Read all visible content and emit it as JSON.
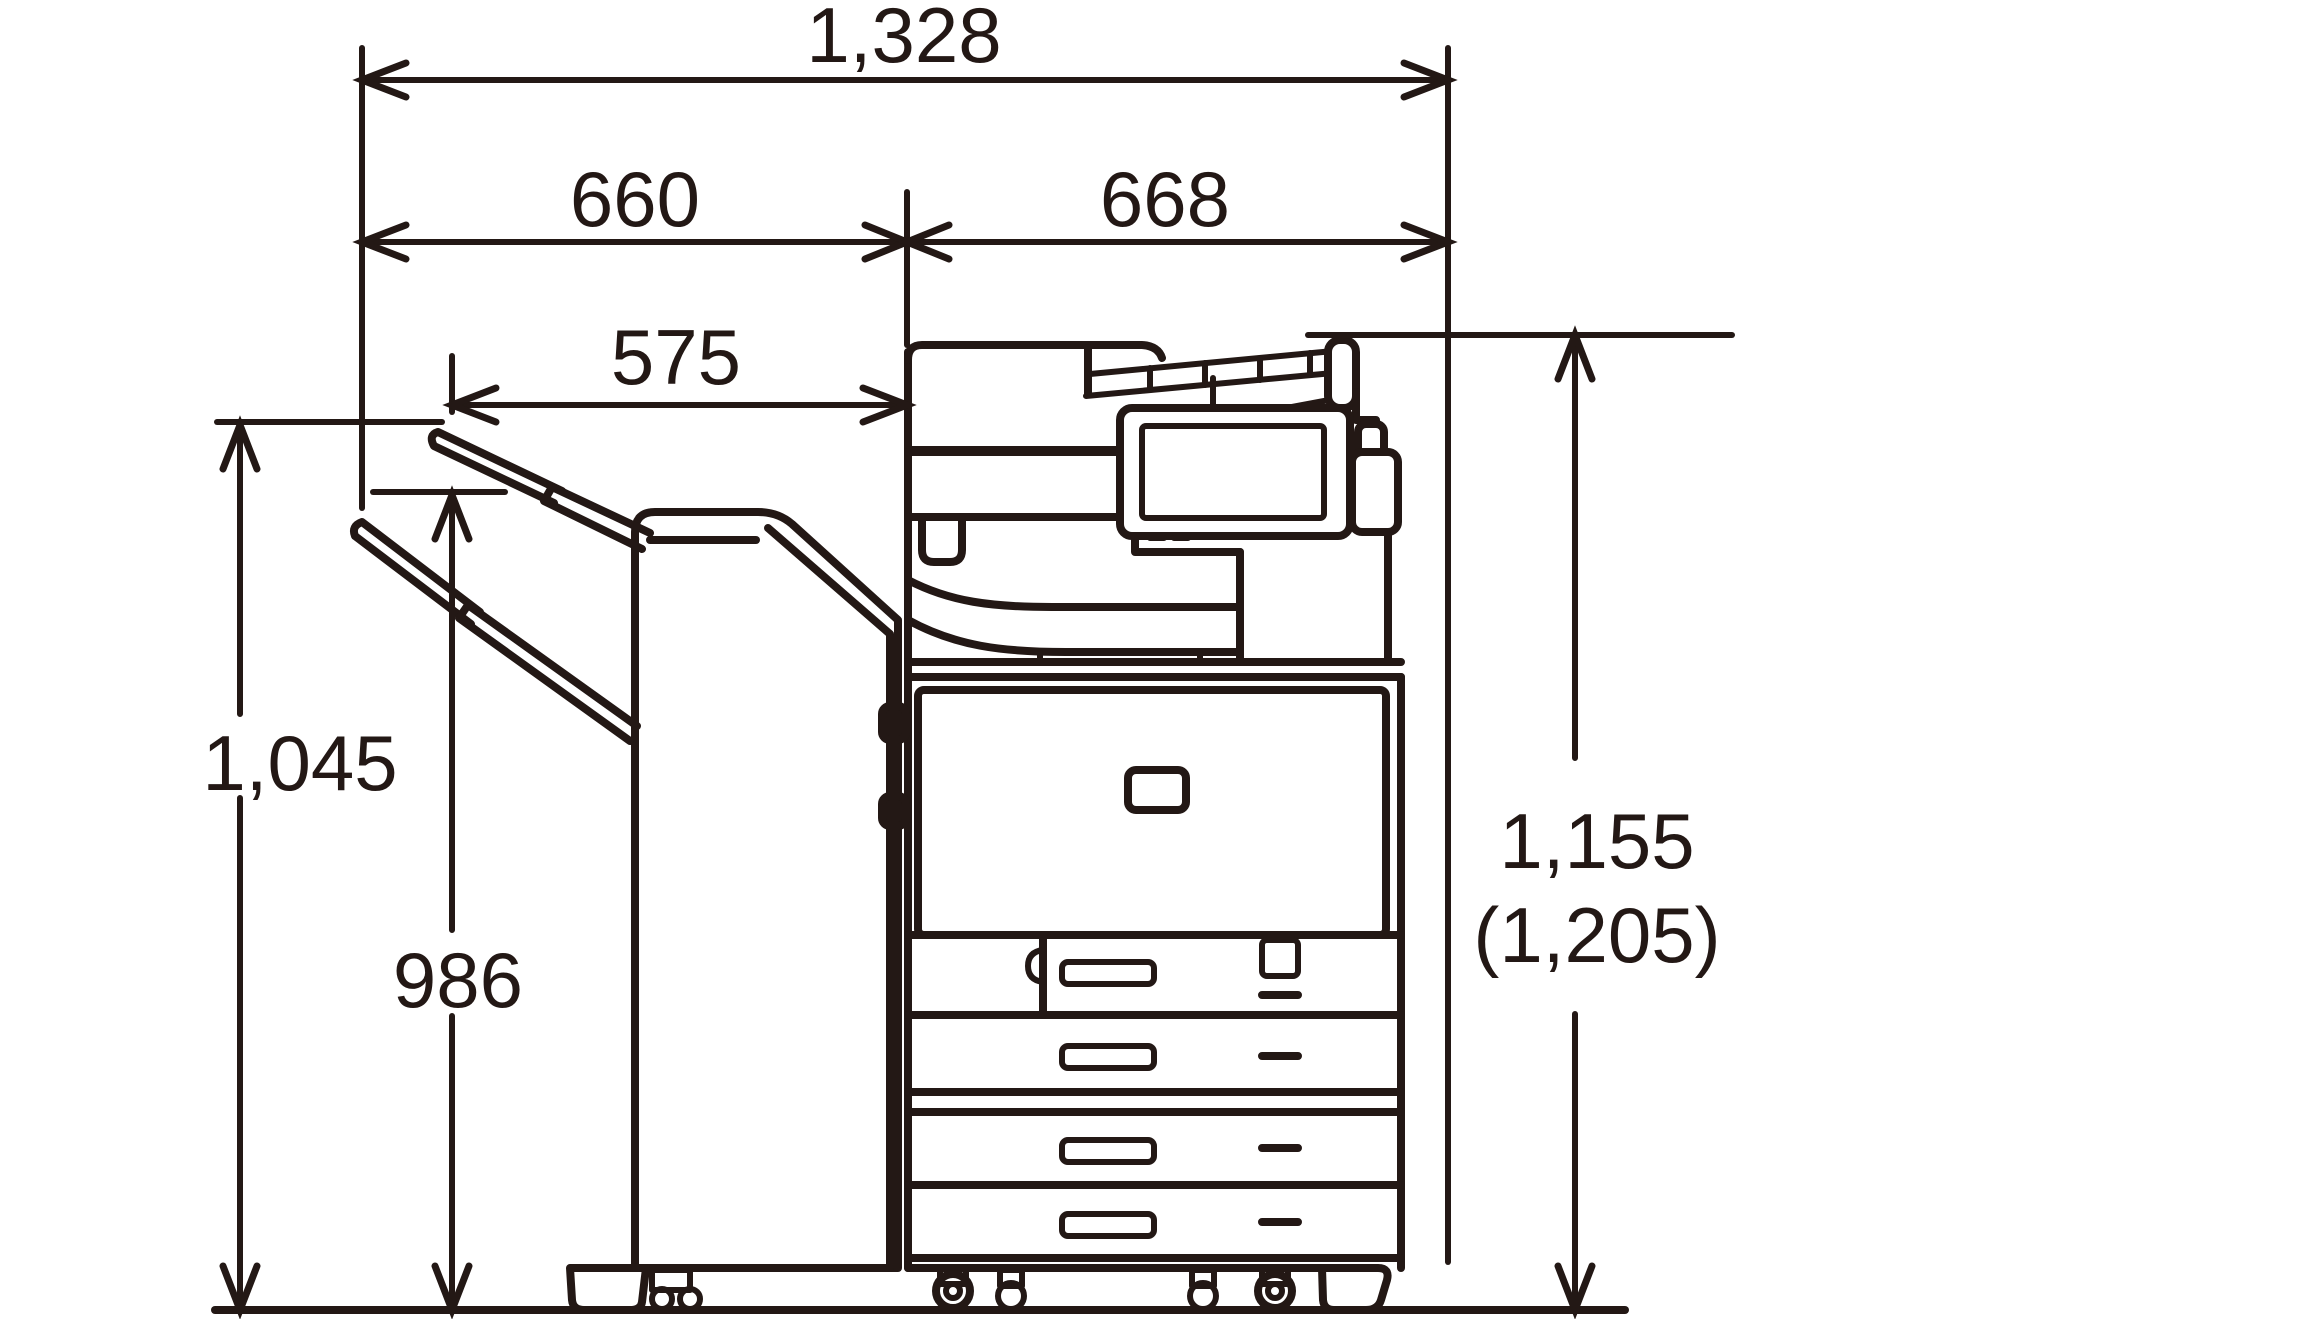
{
  "diagram": {
    "type": "technical-dimension-drawing",
    "subject": "multifunction printer with document feeder and staple finisher, side elevation",
    "line_color": "#231815",
    "background_color": "#ffffff"
  },
  "dimensions": {
    "overall_width": "1,328",
    "finisher_section_width": "660",
    "main_unit_width": "668",
    "output_tray_width": "575",
    "upper_tray_height": "1,045",
    "lower_tray_height": "986",
    "overall_height": "1,155",
    "overall_height_alternate": "(1,205)"
  }
}
